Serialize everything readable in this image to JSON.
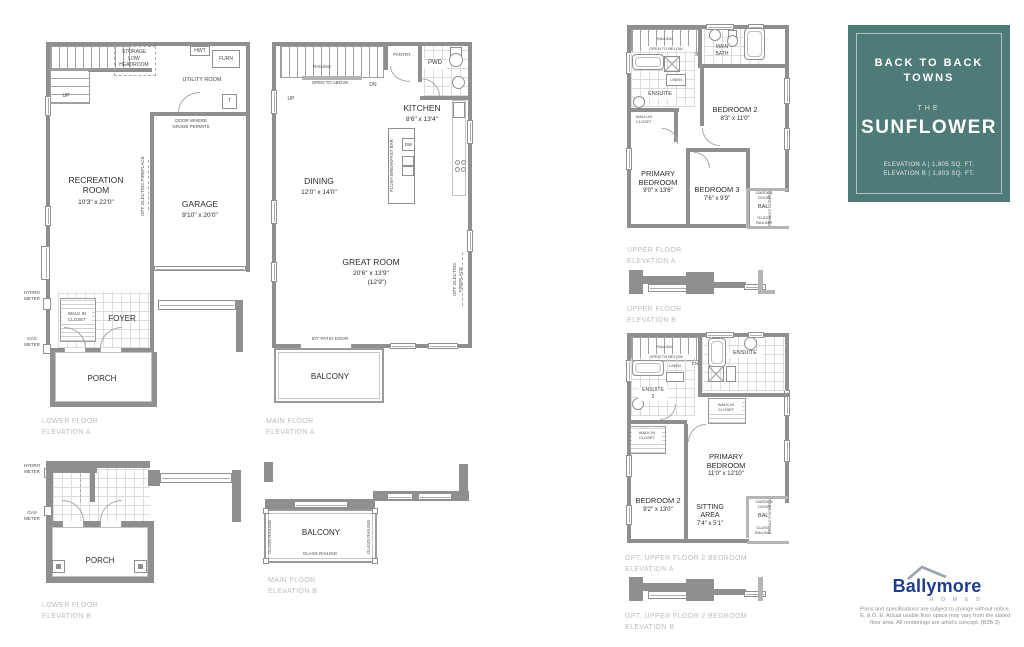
{
  "colors": {
    "wall": "#8f8f8f",
    "card_bg": "#4e7a78",
    "brand_blue": "#1d3e8e",
    "plan_label_gray": "#bdbdbd"
  },
  "card": {
    "title1": "BACK TO BACK",
    "title2": "TOWNS",
    "the": "THE",
    "name": "SUNFLOWER",
    "elev_a": "ELEVATION A  |  1,805 SQ. FT.",
    "elev_b": "ELEVATION B  |  1,803 SQ. FT."
  },
  "brand": {
    "name": "Ballymore",
    "sub": "H O M E S"
  },
  "disclaimer": {
    "lines": [
      "Plans and specifications are subject to change without notice.",
      "E. & O. E. Actual usable floor space may vary from the stated",
      "floor area. All renderings are artist's concept.  (B2B-3)"
    ]
  },
  "plans": {
    "lower_a": {
      "label": "LOWER FLOOR\nELEVATION A",
      "storage": "STORAGE\nLOW\nHEADROOM",
      "hwt": "HWT",
      "furn": "FURN",
      "t": "T",
      "utility": "UTILITY ROOM",
      "up": "UP",
      "door_grade": "DOOR WHERE\nGRADE PERMITS",
      "recreation": "RECREATION\nROOM",
      "recreation_dims": "10'3\" x 22'0\"",
      "garage": "GARAGE",
      "garage_dims": "9'10\" x 20'0\"",
      "fireplace": "OPT. ELECTRIC FIREPLACE",
      "hydro": "HYDRO\nMETER",
      "gas": "GAS\nMETER",
      "wic": "WALK IN\nCLOSET",
      "foyer": "FOYER",
      "porch": "PORCH"
    },
    "main_a": {
      "label": "MAIN FLOOR\nELEVATION A",
      "railing": "RAILING",
      "open_above": "OPEN TO ABOVE",
      "up": "UP",
      "dn": "DN",
      "pantry": "PANTRY",
      "pwd": "PWD",
      "kitchen": "KITCHEN",
      "kitchen_dims": "8'6\" x 13'4\"",
      "dw": "DW",
      "bar": "FLUSH BREAKFAST BAR",
      "dining": "DINING",
      "dining_dims": "12'0\" x 14'0\"",
      "great": "GREAT ROOM",
      "great_dims": "20'6\" x 13'9\"",
      "great_dims2": "(12'9\")",
      "fireplace": "OPT. ELECTRIC FIREPLACE",
      "patio": "6'0\" PATIO DOOR",
      "balcony": "BALCONY"
    },
    "upper_a": {
      "label": "UPPER FLOOR\nELEVATION A",
      "railing": "RAILING",
      "open_below": "OPEN TO BELOW",
      "dn": "DN",
      "main_bath": "MAIN\nBATH",
      "ensuite": "ENSUITE",
      "linen": "LINEN",
      "wic": "WALK-IN\nCLOSET",
      "bedroom2": "BEDROOM 2",
      "bedroom2_dims": "8'3\" x 11'0\"",
      "primary": "PRIMARY\nBEDROOM",
      "primary_dims": "9'0\" x 13'6\"",
      "bedroom3": "BEDROOM 3",
      "bedroom3_dims": "7'6\" x 9'9\"",
      "garden": "GARDEN\nDOOR",
      "bal": "BAL.",
      "glass": "GLASS\nRAILING",
      "privacy": "PRIVACY SCREEN"
    },
    "upper_b": {
      "label": "UPPER FLOOR\nELEVATION B"
    },
    "opt_a": {
      "label": "OPT. UPPER FLOOR 2 BEDROOM\nELEVATION A",
      "railing": "RAILING",
      "open_below": "OPEN TO BELOW",
      "dn": "DN",
      "ensuite": "ENSUITE",
      "ensuite2": "ENSUITE\n2",
      "linen": "LINEN",
      "wic": "WALK-IN\nCLOSET",
      "primary": "PRIMARY\nBEDROOM",
      "primary_dims": "11'0\" x 12'10\"",
      "bedroom2": "BEDROOM 2",
      "bedroom2_dims": "9'2\" x 13'0\"",
      "sitting": "SITTING\nAREA",
      "sitting_dims": "7'4\" x 5'1\"",
      "garden": "GARDEN\nDOOR",
      "bal": "BAL.",
      "glass": "GLASS\nRAILING",
      "privacy": "PRIVACY SCREEN"
    },
    "opt_b": {
      "label": "OPT. UPPER FLOOR 2 BEDROOM\nELEVATION B"
    },
    "lower_b": {
      "label": "LOWER FLOOR\nELEVATION B",
      "hydro": "HYDRO\nMETER",
      "gas": "GAS\nMETER",
      "porch": "PORCH"
    },
    "main_b": {
      "label": "MAIN FLOOR\nELEVATION B",
      "balcony": "BALCONY",
      "glass": "GLASS RAILING",
      "glass_v": "GLASS RAILING"
    }
  }
}
